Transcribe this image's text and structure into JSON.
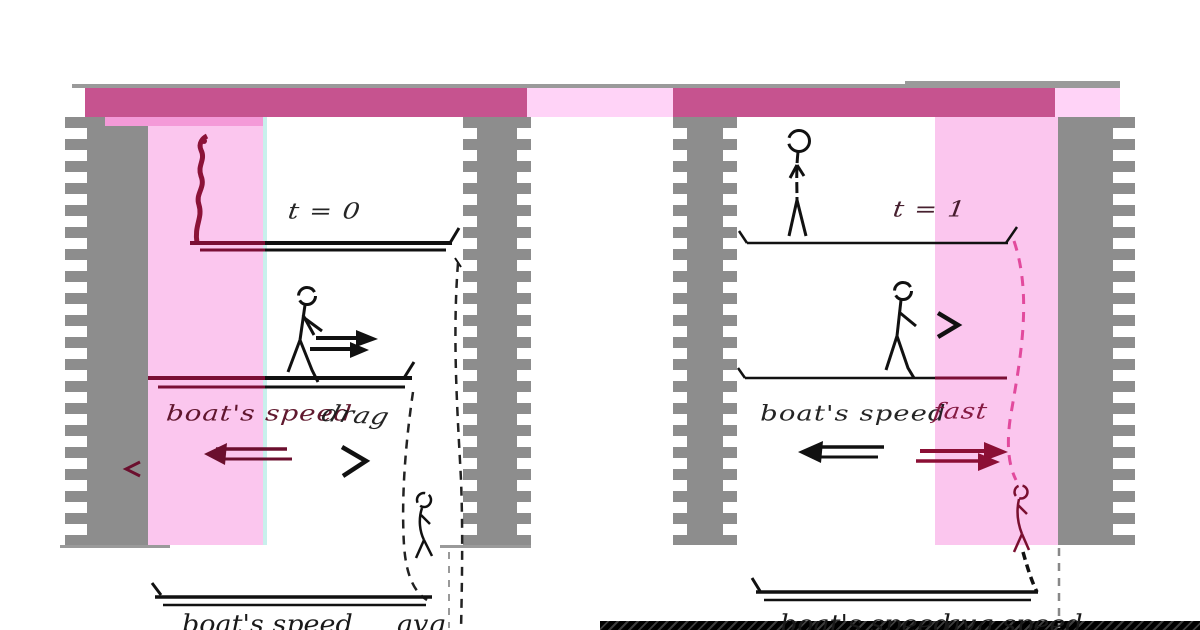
{
  "figure": {
    "description_title": "boat and walker relative-motion diagram, two panels",
    "panels": {
      "left": {
        "time_label": "t = 0",
        "boat_speed_label": "boat's speed",
        "second_label": "drag",
        "caption_a": "boat's speed",
        "caption_b": "avg"
      },
      "right": {
        "time_label": "t = 1",
        "boat_speed_label": "boat's speed",
        "second_label": "fast",
        "caption_a": "boat's speed",
        "caption_b": "avg speed"
      }
    },
    "icons": [
      "walking-person-icon",
      "standing-person-icon",
      "sliding-person-icon",
      "velocity-arrow-right-icon",
      "velocity-arrow-left-icon",
      "chevron-right-icon",
      "dashed-trajectory-curve",
      "boat-line"
    ],
    "colors": {
      "magenta_bar": "#c6538f",
      "light_pink": "#ffd3f7",
      "pink_band": "#fbc6ee",
      "gray_column": "#8d8d8d",
      "maroon_ink": "#7a0f35",
      "black_ink": "#151515",
      "pink_dash": "#e24a9d",
      "cyan_line": "#c8f0ec"
    }
  }
}
